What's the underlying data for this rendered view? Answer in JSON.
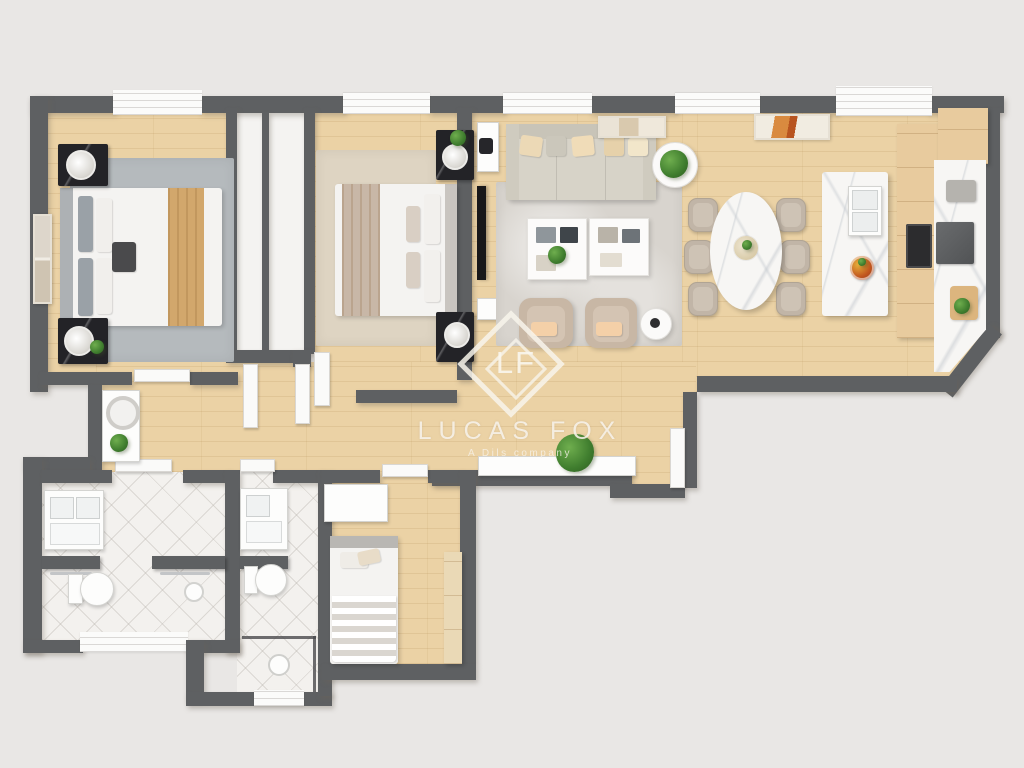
{
  "watermark": {
    "brand": "LUCAS FOX",
    "tagline": "A Dils company",
    "monogram": "LF"
  },
  "plan": {
    "type": "3d-floor-plan-top-view",
    "rooms": [
      {
        "name": "Master bedroom",
        "items": [
          "double bed",
          "tan throw blanket",
          "grey area rug",
          "two black marble nightstands",
          "two table lamps",
          "wall art"
        ]
      },
      {
        "name": "Bedroom 2",
        "items": [
          "double bed",
          "taupe throw blanket",
          "beige area rug",
          "two black marble nightstands",
          "two table lamps",
          "wall-mounted TV"
        ]
      },
      {
        "name": "Built-in closets",
        "items": [
          "two wardrobe doors"
        ]
      },
      {
        "name": "Living room",
        "items": [
          "beige sofa with cushions",
          "two white coffee tables",
          "two taupe armchairs",
          "round side table with plant",
          "small round table",
          "grey area rug",
          "two floor artworks"
        ]
      },
      {
        "name": "Dining area",
        "items": [
          "oval marble dining table",
          "six taupe chairs",
          "flower centerpiece"
        ]
      },
      {
        "name": "Kitchen",
        "items": [
          "marble island with sink",
          "fruit bowl",
          "marble counter",
          "cooktop",
          "built-in oven",
          "coffee machine",
          "cutting board with greens",
          "wood cabinets"
        ]
      },
      {
        "name": "Hallway",
        "items": [
          "dressing table with round mirror",
          "potted plants",
          "white sideboard",
          "entry door"
        ]
      },
      {
        "name": "Bathroom 1",
        "items": [
          "double-sink vanity",
          "toilet",
          "walk-in shower",
          "towel rails"
        ]
      },
      {
        "name": "Bathroom 2",
        "items": [
          "vanity with sink",
          "toilet",
          "glass shower enclosure",
          "shower head"
        ]
      },
      {
        "name": "Bedroom 3",
        "items": [
          "single bed with striped blanket",
          "white wardrobe",
          "built-in closet"
        ]
      }
    ],
    "colors": {
      "background": "#e9e7e5",
      "walls": "#5e6062",
      "wood_floor": "#ebd2a5",
      "tile_floor": "#f3f1ee",
      "marble": "#f7f6f4",
      "master_rug": "#b5babd",
      "bedroom2_rug": "#ded4c2",
      "living_rug": "#d8d4ce",
      "sofa": "#d7d3c8",
      "armchair": "#c8b7a5",
      "tan_blanket": "#d2a76c",
      "nightstand": "#232327",
      "kitchen_wood": "#e8cb9e",
      "plant": "#3f7d2e"
    }
  }
}
